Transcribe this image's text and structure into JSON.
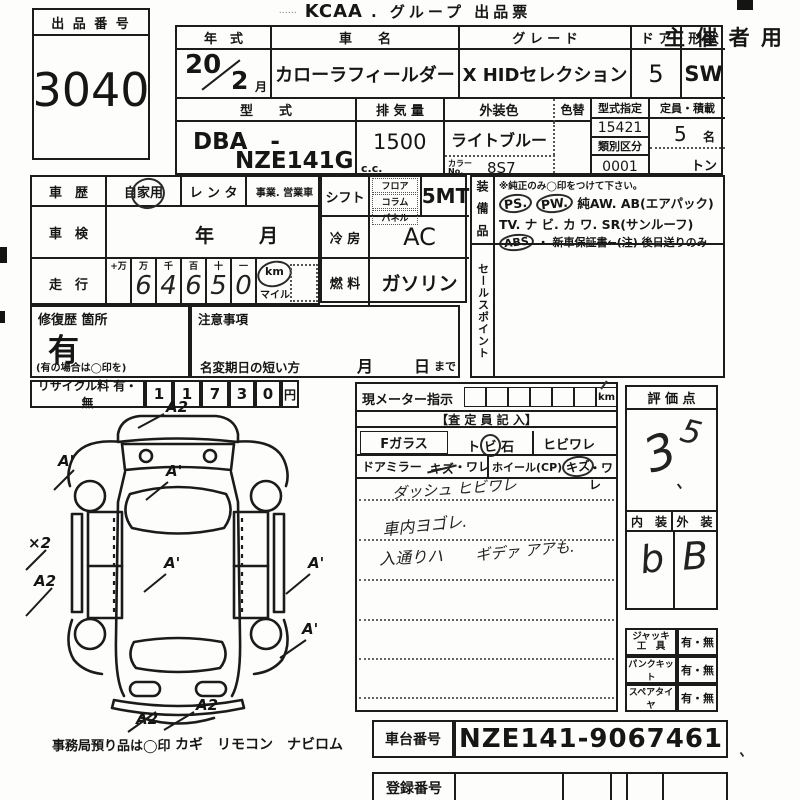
{
  "title": {
    "dots_left": "……",
    "kcaa": "KCAA",
    "rest": ". グループ 出品票",
    "organizer": "主 催 者 用"
  },
  "exhibit": {
    "label": "出 品 番 号",
    "number": "3040"
  },
  "t1": {
    "year_label": "年　式",
    "year": "20",
    "month": "2",
    "month_unit": "月",
    "name_label": "車　　名",
    "name": "カローラフィールダー",
    "grade_label": "グ レ ー ド",
    "grade": "X HIDセレクション",
    "door_label": "ド ア",
    "door": "5",
    "shape_label": "形 状",
    "shape": "SW",
    "model_label": "型　　式",
    "model_line1": "DBA　-",
    "model_line2": "NZE141G",
    "disp_label": "排 気 量",
    "disp": "1500",
    "disp_unit": "c.c.",
    "color_label": "外装色",
    "color": "ライトブルー",
    "color_change": "色替",
    "color_no_label1": "カラー",
    "color_no_label2": "No.",
    "color_no": "8S7",
    "type_label": "型式指定",
    "type_no": "15421",
    "class_label": "類別区分",
    "class_no": "0001",
    "cap_label": "定員・積載",
    "cap": "5",
    "cap_unit": "名",
    "ton": "トン"
  },
  "history": {
    "label": "車　歴",
    "opt1": "自家用",
    "opt2": "レ ン タ",
    "opt3": "事業. 営業車"
  },
  "shaken": {
    "label": "車　検",
    "year": "年",
    "month": "月"
  },
  "mileage": {
    "label": "走　行",
    "h1": "+万",
    "h2": "万",
    "h3": "千",
    "h4": "百",
    "h5": "十",
    "h6": "一",
    "d1": "",
    "d2": "6",
    "d3": "4",
    "d4": "6",
    "d5": "5",
    "d6": "0",
    "km": "km",
    "mile": "マイル"
  },
  "shift": {
    "label": "シフト",
    "opt1": "フロア",
    "opt2": "コラム",
    "opt3": "パネル",
    "value": "5MT"
  },
  "cool": {
    "label": "冷 房",
    "value": "AC"
  },
  "fuel": {
    "label": "燃 料",
    "value": "ガソリン"
  },
  "equip": {
    "label": "装 備 品",
    "note": "※純正のみ◯印をつけて下さい。",
    "ps": "PS.",
    "pw": "PW.",
    "aw": "純AW.",
    "ab": "AB(エアパック)",
    "line2": "TV. ナ ビ. カ ワ. SR(サンルーフ)",
    "abs": "ABS",
    "warranty": "・ 新車保証書←(注) 後日送りのみ"
  },
  "sales": {
    "label": "セールスポイント"
  },
  "repair": {
    "label": "修復歴 箇所",
    "value": "有",
    "note": "(有の場合は◯印を)"
  },
  "caution": {
    "label": "注意事項",
    "deadline": "名変期日の短い方",
    "month": "月",
    "day": "日",
    "made": "まで"
  },
  "recycle": {
    "label": "リサイクル料 有・無",
    "d1": "1",
    "d2": "1",
    "d3": "7",
    "d4": "3",
    "d5": "0",
    "unit": "円"
  },
  "meter": {
    "label": "現メーター指示",
    "km": "km",
    "header": "【査 定 員 記 入】",
    "fglass": "Fガラス",
    "tobi_a": "ト",
    "tobi_b": "ビ",
    "tobi_c": "石",
    "hibi": "ヒビワレ",
    "mirror": "ドアミラー",
    "mirror_kizu": "キズ",
    "mirror_ware": "・ワレ",
    "wheel": "ホイール(CP)",
    "wheel_kizu": "キズ",
    "wheel_ware": "・ワレ",
    "note1": "ダッシュ ヒビワレ",
    "note2": "車内ヨゴレ.",
    "note3": "入通りハ",
    "note4": "ギデァ アアも."
  },
  "rating": {
    "label": "評 価 点",
    "score_main": "3",
    "score_comma": "、",
    "score_sup": "5",
    "int_label": "内　装",
    "ext_label": "外　装",
    "int": "b",
    "ext": "B"
  },
  "acc": {
    "r1l1": "ジャッキ",
    "r1l2": "工　具",
    "r1v": "有・無",
    "r2l": "パンクキット",
    "r2v": "有・無",
    "r3l": "スペアタイヤ",
    "r3v": "有・無"
  },
  "chassis": {
    "label": "車台番号",
    "value": "NZE141-9067461",
    "tick": "、"
  },
  "reg": {
    "label": "登録番号"
  },
  "office": {
    "note": "事務局預り品は◯印",
    "items": "カギ　リモコン　ナビロム"
  },
  "diagram": {
    "m_top": "A2",
    "m_ul": "A'",
    "m_ws": "A'",
    "m_x2": "×2",
    "m_l2": "A2",
    "m_c": "A'",
    "m_r1": "A'",
    "m_r2": "A'",
    "m_b1": "A2",
    "m_b2": "A2"
  }
}
